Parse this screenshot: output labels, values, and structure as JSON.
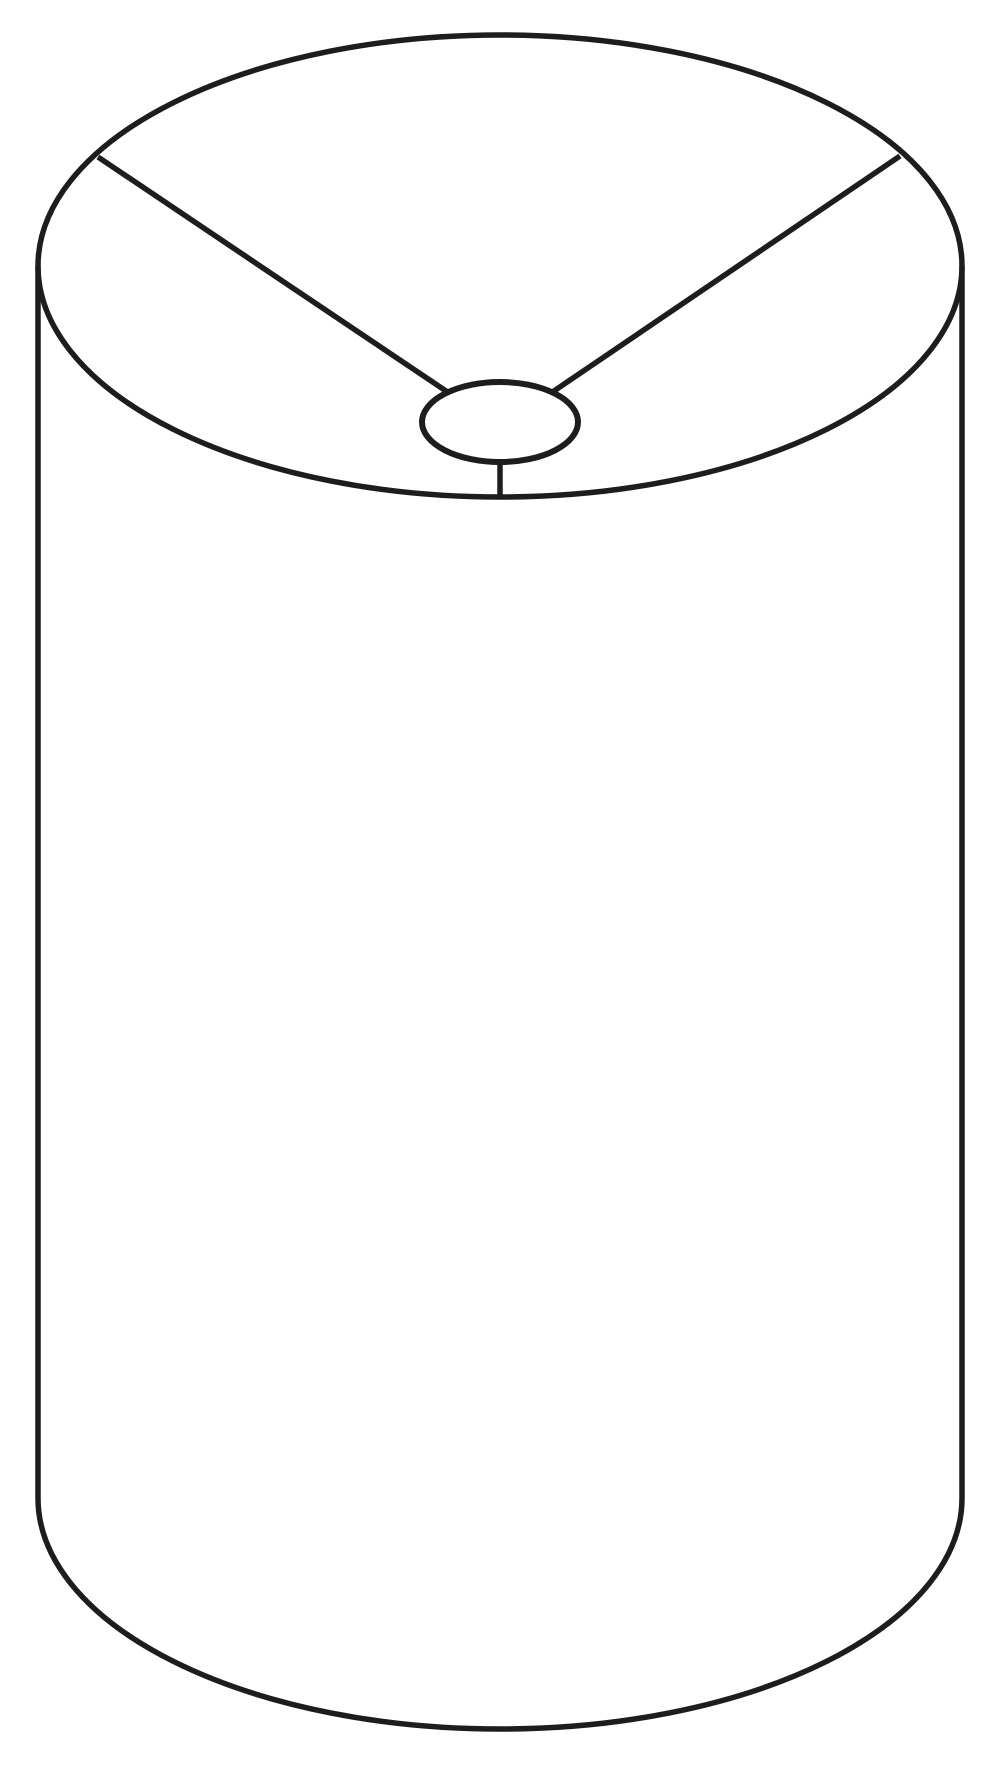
{
  "illustration": {
    "subject": "drum-lampshade-line-drawing",
    "background_color": "#ffffff",
    "stroke_color": "#1d1d1b",
    "stroke_width": 5.5,
    "shapes": {
      "top_rim": {
        "type": "ellipse",
        "cx": 500,
        "cy": 266,
        "rx": 462,
        "ry": 231
      },
      "body_left_edge": {
        "type": "line",
        "x1": 38,
        "y1": 266,
        "x2": 38,
        "y2": 1498
      },
      "body_right_edge": {
        "type": "line",
        "x1": 962,
        "y1": 266,
        "x2": 962,
        "y2": 1498
      },
      "bottom_rim": {
        "type": "bottom-half-ellipse",
        "cx": 500,
        "cy": 1498,
        "rx": 462,
        "ry": 231
      },
      "spider_arm_left": {
        "type": "line",
        "x1": 98,
        "y1": 157,
        "x2": 449,
        "y2": 393
      },
      "spider_arm_right": {
        "type": "line",
        "x1": 900,
        "y1": 156,
        "x2": 551,
        "y2": 393
      },
      "spider_stem": {
        "type": "line",
        "x1": 500,
        "y1": 462,
        "x2": 500,
        "y2": 499
      },
      "fitter_ring": {
        "type": "ellipse",
        "cx": 500,
        "cy": 422,
        "rx": 78,
        "ry": 40,
        "stroke_width": 6,
        "fill": "#ffffff"
      }
    }
  }
}
